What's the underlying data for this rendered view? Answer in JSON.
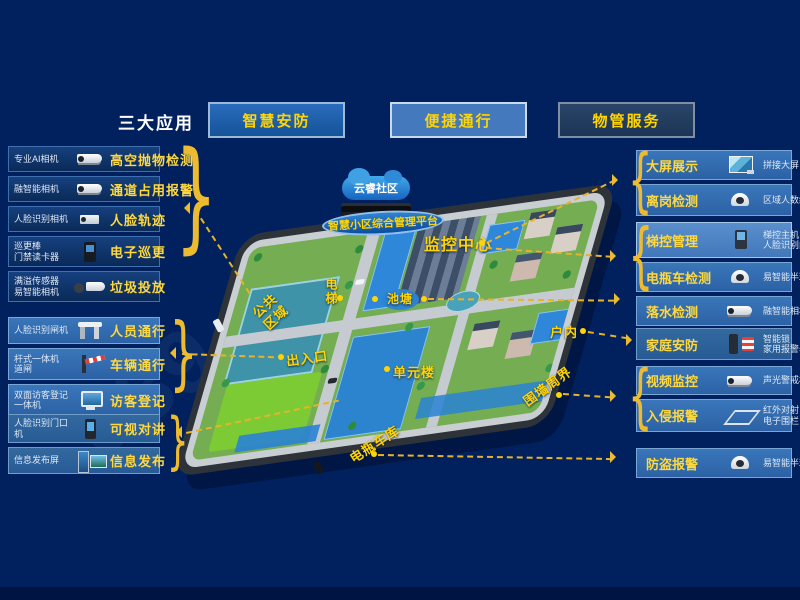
{
  "header": {
    "title": "三大应用",
    "buttons": [
      {
        "label": "智慧安防"
      },
      {
        "label": "便捷通行"
      },
      {
        "label": "物管服务"
      }
    ]
  },
  "left_panel": {
    "groups": [
      {
        "items": [
          {
            "device": "专业AI相机",
            "feature": "高空抛物检测",
            "icon": "bullet-camera"
          },
          {
            "device": "融智能相机",
            "feature": "通道占用报警",
            "icon": "bullet-camera"
          },
          {
            "device": "人脸识别相机",
            "feature": "人脸轨迹",
            "icon": "box-camera"
          },
          {
            "device": "巡更棒\n门禁读卡器",
            "feature": "电子巡更",
            "icon": "card-reader"
          },
          {
            "device": "满溢传感器\n易智能相机",
            "feature": "垃圾投放",
            "icon": "sensor-camera"
          }
        ]
      },
      {
        "items": [
          {
            "device": "人脸识别闸机",
            "feature": "人员通行",
            "icon": "turnstile-gate"
          },
          {
            "device": "杆式一体机\n道闸",
            "feature": "车辆通行",
            "icon": "barrier-gate"
          },
          {
            "device": "双面访客登记\n一体机",
            "feature": "访客登记",
            "icon": "visitor-kiosk"
          }
        ]
      },
      {
        "items": [
          {
            "device": "人脸识别门口\n机",
            "feature": "可视对讲",
            "icon": "door-station"
          },
          {
            "device": "信息发布屏",
            "feature": "信息发布",
            "icon": "info-screen"
          }
        ]
      }
    ]
  },
  "right_panel": {
    "groups": [
      {
        "items": [
          {
            "feature": "大屏展示",
            "device": "拼接大屏",
            "icon": "video-wall"
          },
          {
            "feature": "离岗检测",
            "device": "区域人数统计",
            "icon": "dome-camera"
          }
        ]
      },
      {
        "items": [
          {
            "feature": "梯控管理",
            "device": "梯控主机\n人脸识别门禁",
            "icon": "face-terminal"
          },
          {
            "feature": "电瓶车检测",
            "device": "易智能半球",
            "icon": "dome-camera"
          }
        ]
      },
      {
        "items": [
          {
            "feature": "落水检测",
            "device": "融智能相机",
            "icon": "bullet-camera"
          }
        ]
      },
      {
        "items": [
          {
            "feature": "家庭安防",
            "device": "智能锁\n家用报警器",
            "icon": "lock-alarm"
          }
        ]
      },
      {
        "items": [
          {
            "feature": "视频监控",
            "device": "声光警戒相机",
            "icon": "bullet-camera"
          },
          {
            "feature": "入侵报警",
            "device": "红外对射\n电子围栏",
            "icon": "perimeter-fence"
          }
        ]
      },
      {
        "items": [
          {
            "feature": "防盗报警",
            "device": "易智能半球",
            "icon": "dome-camera"
          }
        ]
      }
    ]
  },
  "platform": {
    "cloud": "云睿社区",
    "name": "智慧小区综合管理平台"
  },
  "map_labels": {
    "monitor_center": "监控中心",
    "elevator": "电梯",
    "pond": "池塘",
    "public_area": "公共\n区域",
    "entrance": "出入口",
    "unit_building": "单元楼",
    "indoor": "户内",
    "perimeter": "围墙周界",
    "bike_garage": "电瓶车库"
  },
  "watermark": {
    "part1": "339",
    "part2": "2020-09"
  },
  "icons": {
    "brace_left": "}",
    "brace_right": "{"
  },
  "colors": {
    "background": "#01215e",
    "accent_yellow": "#ffd400",
    "line_yellow": "#e6b32a",
    "panel_dark": "#0a2a58",
    "panel_blue": "#2c62a5",
    "panel_light": "#4d85c6"
  }
}
